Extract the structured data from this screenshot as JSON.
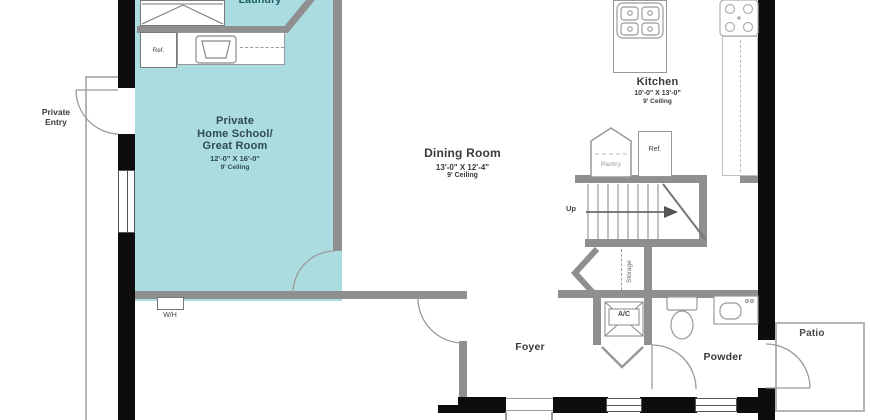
{
  "title": "First floor plan",
  "colors": {
    "room_fill_teal": "#abdcdf",
    "wall_gray": "#8f8f8f",
    "wall_black": "#0d0d0d",
    "accent_text": "#2e4a52"
  },
  "rooms": {
    "great_room": {
      "name_line1": "Private",
      "name_line2": "Home School/",
      "name_line3": "Great Room",
      "dims": "12'-0\" X 16'-0\"",
      "ceiling": "9' Ceiling"
    },
    "dining": {
      "name": "Dining Room",
      "dims": "13'-0\" X 12'-4\"",
      "ceiling": "9' Ceiling"
    },
    "kitchen": {
      "name": "Kitchen",
      "dims": "10'-0\" X 13'-0\"",
      "ceiling": "9' Ceiling"
    },
    "laundry": {
      "name": "Laundry"
    },
    "foyer": {
      "name": "Foyer"
    },
    "powder": {
      "name": "Powder"
    },
    "patio": {
      "name": "Patio"
    },
    "private_entry": {
      "name_line1": "Private",
      "name_line2": "Entry"
    }
  },
  "labels": {
    "up": "Up",
    "storage": "Storage",
    "pantry": "Pantry",
    "ref_great_room": "Ref.",
    "ref_kitchen": "Ref.",
    "water_heater": "W/H",
    "ac": "A/C"
  }
}
